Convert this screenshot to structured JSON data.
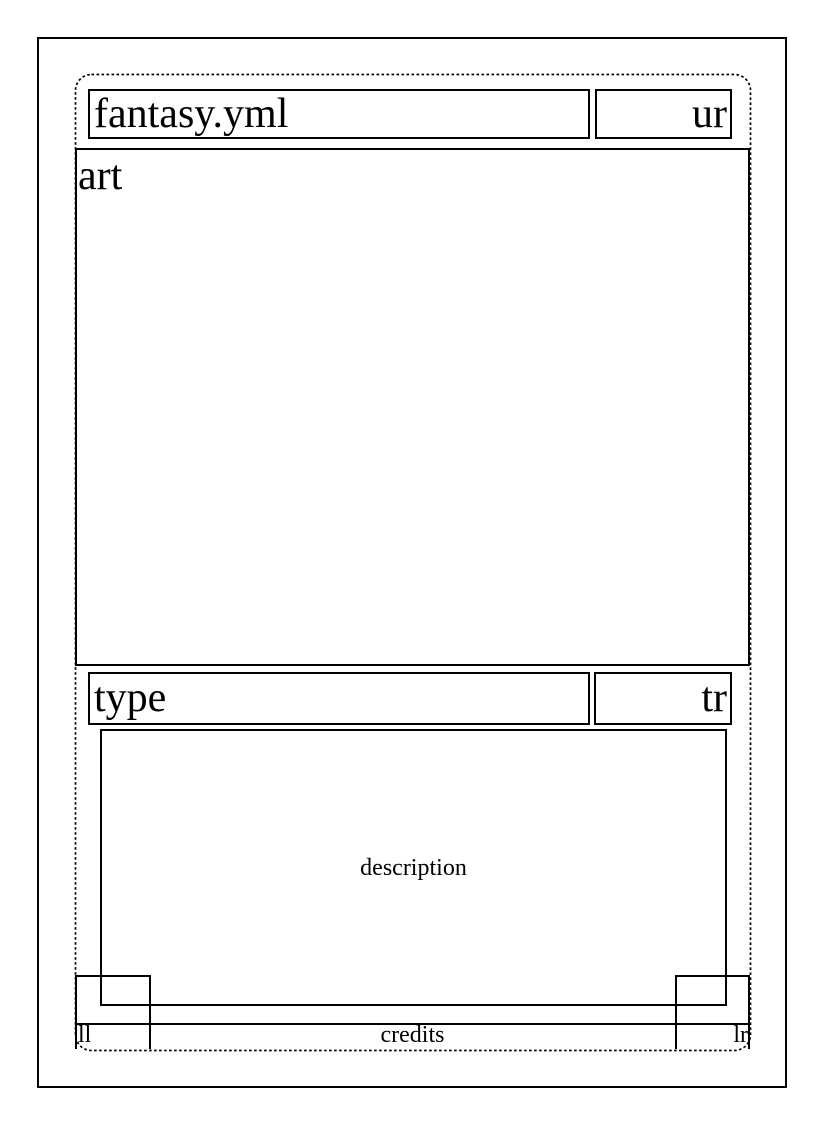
{
  "card_template": {
    "title": "fantasy.yml",
    "upper_right_label": "ur",
    "art_label": "art",
    "type_label": "type",
    "type_right_label": "tr",
    "description_label": "description",
    "lower_left_label": "ll",
    "credits_label": "credits",
    "lower_right_label": "lr"
  },
  "colors": {
    "line": "#000000",
    "text": "#000000",
    "background": "#ffffff"
  }
}
